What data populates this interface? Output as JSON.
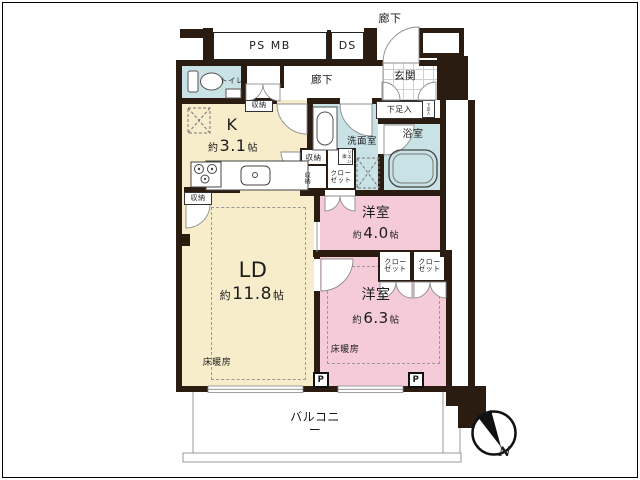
{
  "outside": {
    "ps_mb": "PS MB",
    "ds": "DS",
    "corridor": "廊下"
  },
  "entrance": {
    "genkan": "玄関",
    "shoe_cabinet": "下足入",
    "shoe_cabinet_small": "下足入"
  },
  "hall": {
    "corridor": "廊下",
    "toilet": "トイレ",
    "storage": "収納"
  },
  "kitchen": {
    "name": "K",
    "size_prefix": "約",
    "size_value": "3.1",
    "size_unit": "帖",
    "storage": "収納"
  },
  "sanitary": {
    "washroom": "洗面室",
    "bathroom": "浴室"
  },
  "center_storage": {
    "storage": "収納",
    "storage_side": "収納",
    "linen": "リネン庫",
    "closet": "クローゼット"
  },
  "living": {
    "name": "LD",
    "size_prefix": "約",
    "size_value": "11.8",
    "size_unit": "帖",
    "floor_heating": "床暖房"
  },
  "bedroom1": {
    "name": "洋室",
    "size_prefix": "約",
    "size_value": "4.0",
    "size_unit": "帖",
    "closet_a": "クローゼット",
    "closet_b": "クローゼット"
  },
  "bedroom2": {
    "name": "洋室",
    "size_prefix": "約",
    "size_value": "6.3",
    "size_unit": "帖",
    "floor_heating": "床暖房"
  },
  "balcony": {
    "name": "バルコニー"
  },
  "markers": {
    "pipe_a": "P",
    "pipe_b": "P",
    "north": "N"
  },
  "colors": {
    "wall": "#2b1c12",
    "living": "#f7edcb",
    "bedroom": "#f5cbd9",
    "wet": "#c9e2e6"
  }
}
